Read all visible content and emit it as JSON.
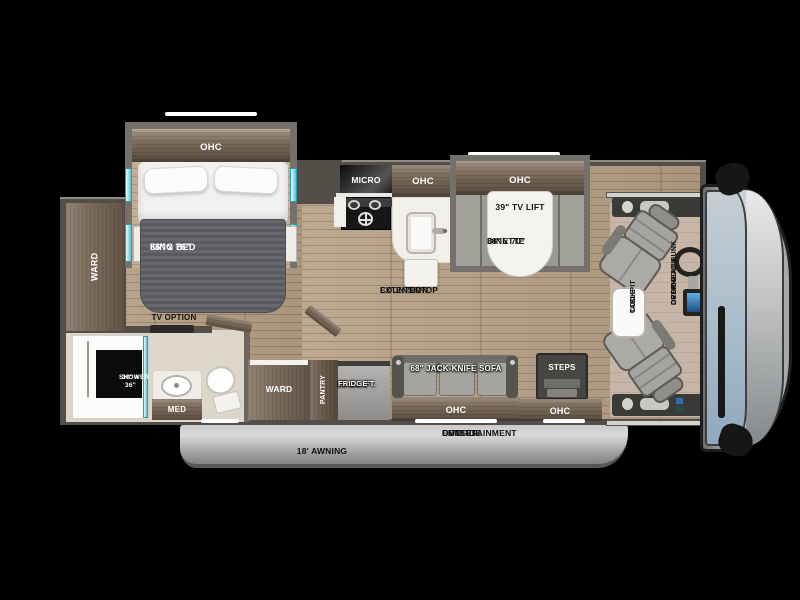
{
  "floorplan": {
    "bedroom": {
      "ohc": "OHC",
      "king_bed_size": "66\" x 76\"",
      "king_bed": "KING BED",
      "ward": "WARD",
      "tv_option": "TV OPTION"
    },
    "bathroom": {
      "shower_size": "30\" x 36\"",
      "shower": "SHOWER",
      "med": "MED"
    },
    "kitchen": {
      "micro": "MICRO",
      "ohc": "OHC",
      "countertop_line1": "COUNTERTOP",
      "countertop_line2": "EXTENSION"
    },
    "dinette": {
      "ohc": "OHC",
      "tv_lift": "39\" TV LIFT",
      "dinette_size": "38\" x 70\"",
      "dinette": "DINETTE"
    },
    "galley": {
      "ward": "WARD",
      "pantry": "PANTRY",
      "fridge_line1": "10 CU. FT.",
      "fridge_line2": "FRIDGE",
      "sofa": "68\" JACK-KNIFE SOFA",
      "sofa_ohc": "OHC",
      "steps": "STEPS",
      "entry_ohc": "OHC"
    },
    "cockpit": {
      "table_line1": "COCKPIT",
      "table_line2": "TABLE",
      "bunk_line1": "DROP-DOWN",
      "bunk_line2": "OVERHEAD BUNK",
      "bunk_line3": "OPTION"
    },
    "exterior": {
      "awning": "18' AWNING",
      "entertainment_line1": "OUTSIDE",
      "entertainment_line2": "ENTERTAINMENT",
      "entertainment_line3": "CENTER"
    }
  },
  "colors": {
    "background": "#000000",
    "floor_wood": "#b3a089",
    "cabinet_wood": "#7e6d5c",
    "wall": "#534e47",
    "slide_wall": "#74716c",
    "accent_teal": "#54c6d6",
    "mattress_gray": "#606066",
    "windshield_blue": "#abbecb",
    "awning_gray": "#a2a2a2",
    "table_white": "#f5f3ef"
  }
}
